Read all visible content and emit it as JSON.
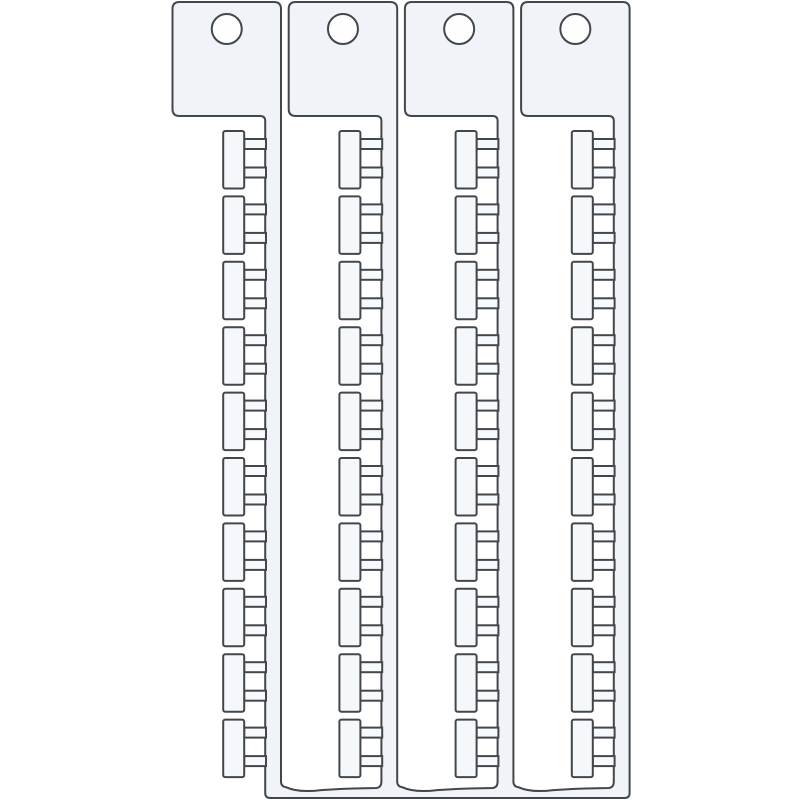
{
  "illustration": {
    "name": "cable-marker-comb-strips-drawing",
    "canvas": {
      "width": 800,
      "height": 800
    },
    "colors": {
      "background": "#ffffff",
      "outline": "#43474c",
      "piece_fill": "#f0f4f8",
      "tag_fill": "#f4f8fb",
      "bridge_fill": "#f7fafc",
      "hole_fill": "#fefefe"
    },
    "stroke_width": 2,
    "strips": {
      "count": 4,
      "first_left": 172.5,
      "pitch": 116.2,
      "tab_width": 108.5,
      "tab_top": 2,
      "tab_height": 114,
      "corner_radius": 7,
      "inner_radius": 5,
      "spine_width": 15.8,
      "hole": {
        "cx_offset": 54.25,
        "cy": 29,
        "r": 15
      }
    },
    "tags": {
      "per_strip": 10,
      "first_top": 131,
      "pitch": 65.4,
      "width": 21,
      "height": 57.5,
      "corner_radius": 2,
      "bridge": {
        "width": 21.8,
        "height": 10,
        "offsets": [
          8,
          36.5
        ]
      }
    },
    "base_bar": {
      "slot_bottom_y": 786.5,
      "bottom": 798,
      "corner_radius": 5,
      "wave_dip": 4.8
    }
  }
}
